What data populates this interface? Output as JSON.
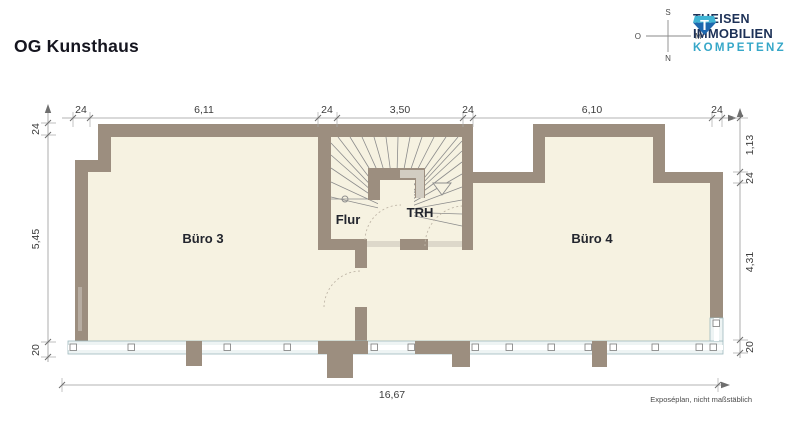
{
  "header": {
    "title": "OG Kunsthaus"
  },
  "logo": {
    "line1": "THEISEN",
    "line2": "IMMOBILIEN",
    "line3": "KOMPETENZ",
    "gem_letter": "T"
  },
  "compass": {
    "top": "S",
    "right": "M",
    "bottom": "N",
    "left": "O"
  },
  "rooms": [
    {
      "label": "Büro 3"
    },
    {
      "label": "Flur"
    },
    {
      "label": "TRH"
    },
    {
      "label": "Büro 4"
    }
  ],
  "dimensions": {
    "top": [
      "24",
      "6,11",
      "24",
      "3,50",
      "24",
      "6,10",
      "24"
    ],
    "left": [
      "24",
      "5,45",
      "20"
    ],
    "right": [
      "1,13",
      "24",
      "4,31",
      "20"
    ],
    "bottom": [
      "16,67"
    ]
  },
  "footnote": "Exposéplan, nicht maßstäblich",
  "colors": {
    "wall": "#9c8e7f",
    "floor": "#f6f2e1",
    "window_frame": "#9db9be",
    "brand_navy": "#1d3157",
    "brand_teal": "#36a7c8",
    "dimension_text": "#3c3c3c"
  }
}
